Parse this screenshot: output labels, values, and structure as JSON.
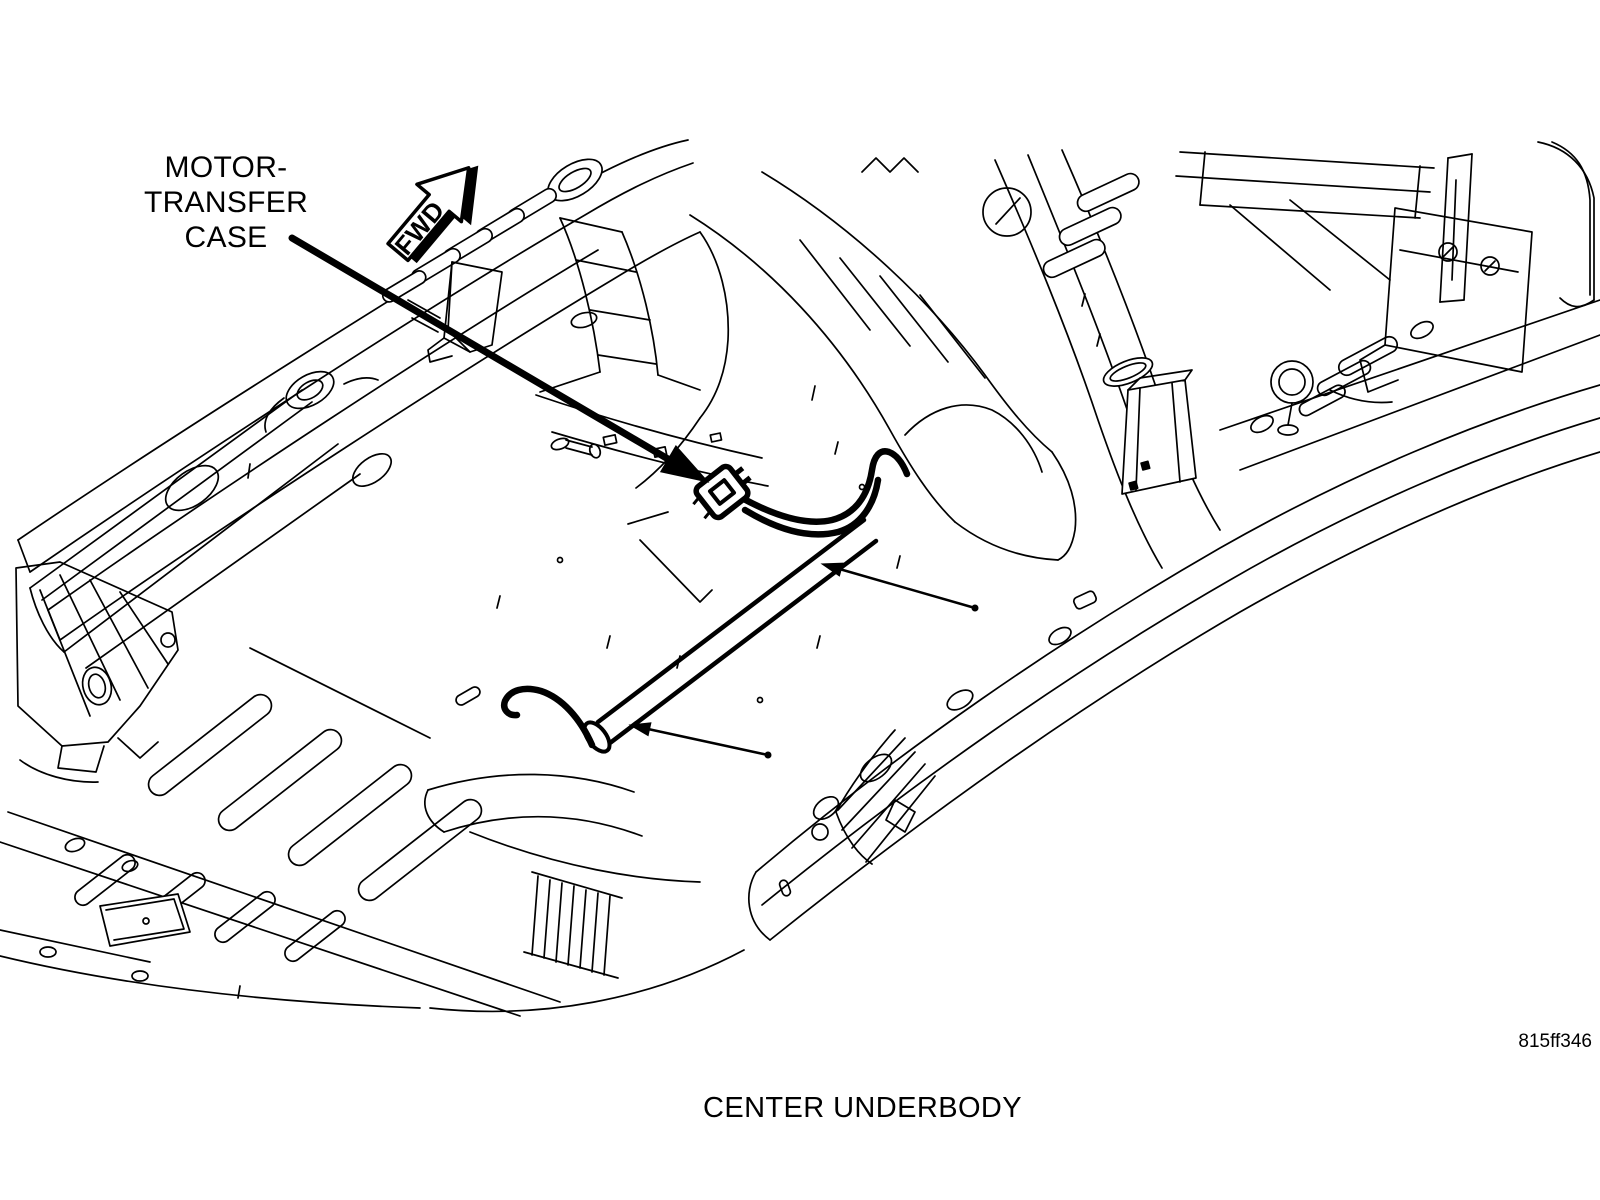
{
  "figure": {
    "background_color": "#ffffff",
    "line_color": "#000000",
    "callout": {
      "line1": "MOTOR-",
      "line2": "TRANSFER",
      "line3": "CASE"
    },
    "direction_arrow_label": "FWD",
    "caption": "CENTER UNDERBODY",
    "figure_code": "815ff346"
  }
}
